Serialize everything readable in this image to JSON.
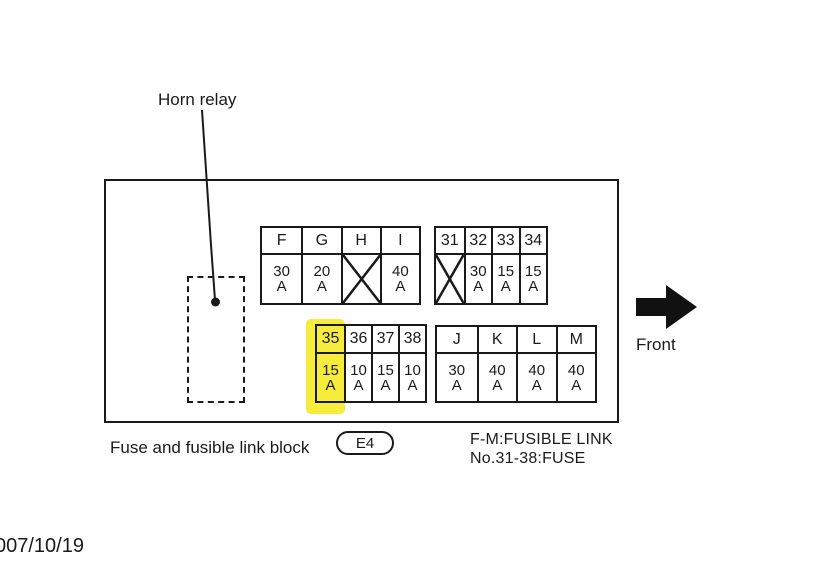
{
  "diagram": {
    "horn_relay_label": "Horn relay",
    "front_label": "Front",
    "caption": "Fuse and fusible link block",
    "connector_code": "E4",
    "legend": {
      "line1": "F-M:FUSIBLE LINK",
      "line2": "No.31-38:FUSE"
    },
    "date_stamp": "007/10/19"
  },
  "tables": {
    "fusible_link_top": {
      "columns": [
        {
          "id": "F",
          "amp": "30",
          "unit": "A"
        },
        {
          "id": "G",
          "amp": "20",
          "unit": "A"
        },
        {
          "id": "H",
          "crossed": true
        },
        {
          "id": "I",
          "amp": "40",
          "unit": "A"
        }
      ]
    },
    "fuse_top": {
      "columns": [
        {
          "id": "31",
          "crossed": true
        },
        {
          "id": "32",
          "amp": "30",
          "unit": "A"
        },
        {
          "id": "33",
          "amp": "15",
          "unit": "A"
        },
        {
          "id": "34",
          "amp": "15",
          "unit": "A"
        }
      ]
    },
    "fuse_bottom": {
      "highlighted_column": "35",
      "columns": [
        {
          "id": "35",
          "amp": "15",
          "unit": "A"
        },
        {
          "id": "36",
          "amp": "10",
          "unit": "A"
        },
        {
          "id": "37",
          "amp": "15",
          "unit": "A"
        },
        {
          "id": "38",
          "amp": "10",
          "unit": "A"
        }
      ]
    },
    "fusible_link_bottom": {
      "columns": [
        {
          "id": "J",
          "amp": "30",
          "unit": "A"
        },
        {
          "id": "K",
          "amp": "40",
          "unit": "A"
        },
        {
          "id": "L",
          "amp": "40",
          "unit": "A"
        },
        {
          "id": "M",
          "amp": "40",
          "unit": "A"
        }
      ]
    }
  },
  "colors": {
    "highlight": "#f6ec3c",
    "ink": "#1a1a1a"
  }
}
